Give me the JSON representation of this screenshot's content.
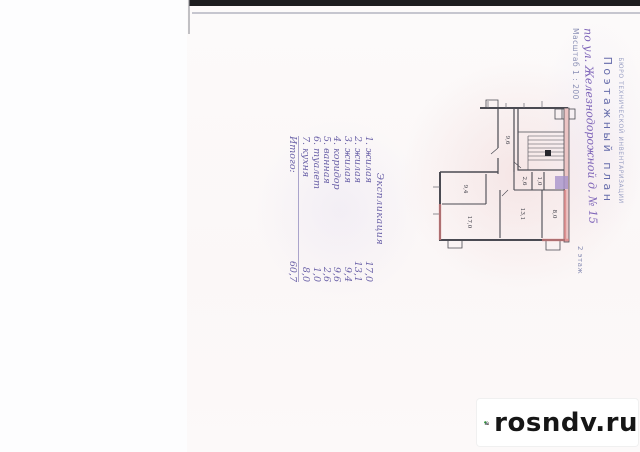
{
  "stamp": {
    "org_line": "БЮРО ТЕХНИЧЕСКОЙ ИНВЕНТАРИЗАЦИИ",
    "title": "Поэтажный план",
    "address_handwritten": "по ул. Железнодорожной д. № 15",
    "scale_line": "Масштаб 1 : 200",
    "floor_label": "2 этаж"
  },
  "explication": {
    "title": "Экспликация",
    "items": [
      {
        "num": "1.",
        "name": "жилая",
        "area": "17,0"
      },
      {
        "num": "2.",
        "name": "жилая",
        "area": "13,1"
      },
      {
        "num": "3.",
        "name": "жилая",
        "area": "9,4"
      },
      {
        "num": "4.",
        "name": "коридор",
        "area": "9,6"
      },
      {
        "num": "5.",
        "name": "ванная",
        "area": "2,6"
      },
      {
        "num": "6.",
        "name": "туалет",
        "area": "1,0"
      },
      {
        "num": "7.",
        "name": "кухня",
        "area": "8,0"
      }
    ],
    "total_label": "Итого:",
    "total": "60,7"
  },
  "plan": {
    "room_labels": [
      "9,4",
      "17,0",
      "13,1",
      "2,6",
      "1,0",
      "8,0",
      "9,6"
    ]
  },
  "watermark": {
    "text": "rosndv.ru",
    "icon": "house-with-tree-icon"
  },
  "colors": {
    "ink_handwriting": "#6b62a8",
    "stamp_blue": "#6a6fae",
    "wall_line": "#4a4a52",
    "wall_highlight_pink": "#d87f7f",
    "patch_purple": "#a894cc",
    "logo_green": "#3a9e45",
    "logo_blue": "#3b6fd4",
    "logo_red": "#cc3333",
    "scan_bar_black": "#1d1d1f"
  }
}
